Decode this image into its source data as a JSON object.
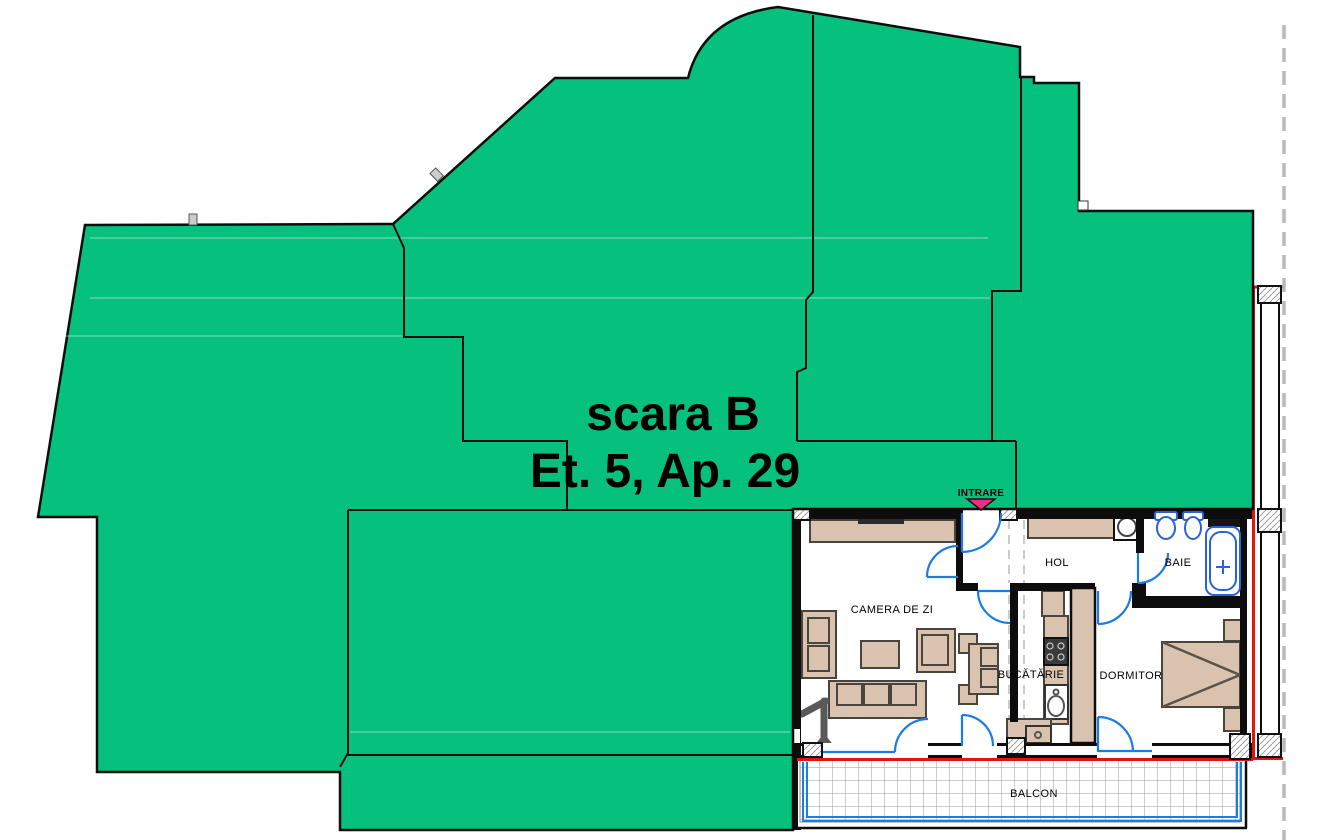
{
  "title": {
    "line1": "scara B",
    "line2": "Et. 5, Ap. 29"
  },
  "entrance": {
    "label": "INTRARE"
  },
  "rooms": {
    "living_room": "CAMERA DE ZI",
    "hallway": "HOL",
    "bathroom": "BAIE",
    "kitchen": "BUCĂTĂRIE",
    "bedroom": "DORMITOR",
    "balcony": "BALCON"
  },
  "colors": {
    "mask_green": "#06c07e",
    "outline_black": "#0d0d0d",
    "door_blue": "#1b7ce6",
    "fixture_blue": "#2a62d8",
    "apartment_boundary_red": "#e01414",
    "entrance_arrow_pink": "#ee2d86",
    "furniture_tan": "#d9c3ae",
    "balcony_grid_gray": "#9a9a9a",
    "section_dash_gray": "#b9b9b9"
  }
}
